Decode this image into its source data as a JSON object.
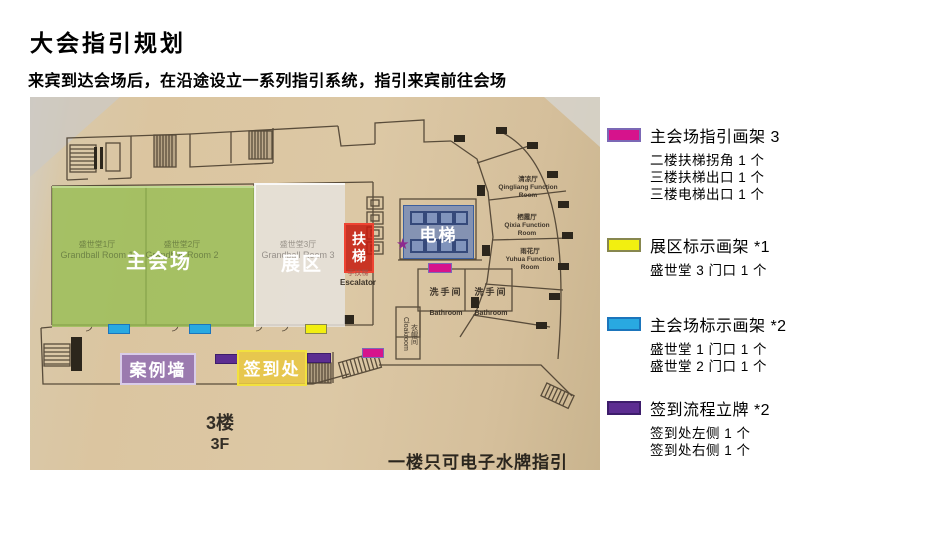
{
  "slide": {
    "title": "大会指引规划",
    "subtitle": "来宾到达会场后，在沿途设立一系列指引系统，指引来宾前往会场"
  },
  "floorplan": {
    "floor_cn": "3楼",
    "floor_en": "3F",
    "note": "一楼只可电子水牌指引",
    "labels": {
      "main_hall": "主会场",
      "expo_zone": "展区",
      "escalator_char1": "扶",
      "escalator_char2": "梯",
      "elevator": "电梯",
      "case_wall": "案例墙",
      "checkin": "签到处"
    },
    "rooms": {
      "grandball1_cn": "盛世堂1厅",
      "grandball1_en": "Grandball Room 1",
      "grandball2_cn": "盛世堂2厅",
      "grandball2_en": "Grandball Room 2",
      "grandball3_cn": "盛世堂3厅",
      "grandball3_en": "Grandball Room 3",
      "bathroom_cn": "洗手间",
      "bathroom_en": "Bathroom",
      "cloakroom_cn": "衣帽间",
      "cloakroom_en": "Cloakroom",
      "escalator_cn": "手扶梯",
      "escalator_en": "Escalator",
      "qingliang_cn": "清凉厅",
      "qingliang_en": "Qingliang Function Room",
      "qixia_cn": "栖霞厅",
      "qixia_en": "Qixia Function Room",
      "yuhua_cn": "雨花厅",
      "yuhua_en": "Yuhua Function Room"
    },
    "overlay_colors": {
      "main_hall_green": "#9ac04f",
      "expo_gray": "#dddad4",
      "escalator_red": "#cc2114",
      "elevator_blue": "#5f7db9",
      "case_wall_purple": "#9673b4",
      "checkin_gold": "#e9c740"
    }
  },
  "legend": {
    "items": [
      {
        "label": "主会场指引画架 3",
        "color": "#d6138c",
        "border": "#7b68b5",
        "details": [
          "二楼扶梯拐角 1 个",
          "三楼扶梯出口 1 个",
          "三楼电梯出口 1 个"
        ]
      },
      {
        "label": "展区标示画架 *1",
        "color": "#f2ef10",
        "border": "#87874f",
        "details": [
          "盛世堂 3 门口 1 个"
        ]
      },
      {
        "label": "主会场标示画架 *2",
        "color": "#29a9e1",
        "border": "#1b75bc",
        "details": [
          "盛世堂 1 门口 1 个",
          "盛世堂 2 门口 1 个"
        ]
      },
      {
        "label": "签到流程立牌 *2",
        "color": "#5c2d91",
        "border": "#3d1d6b",
        "details": [
          "签到处左侧 1 个",
          "签到处右侧 1 个"
        ]
      }
    ]
  }
}
